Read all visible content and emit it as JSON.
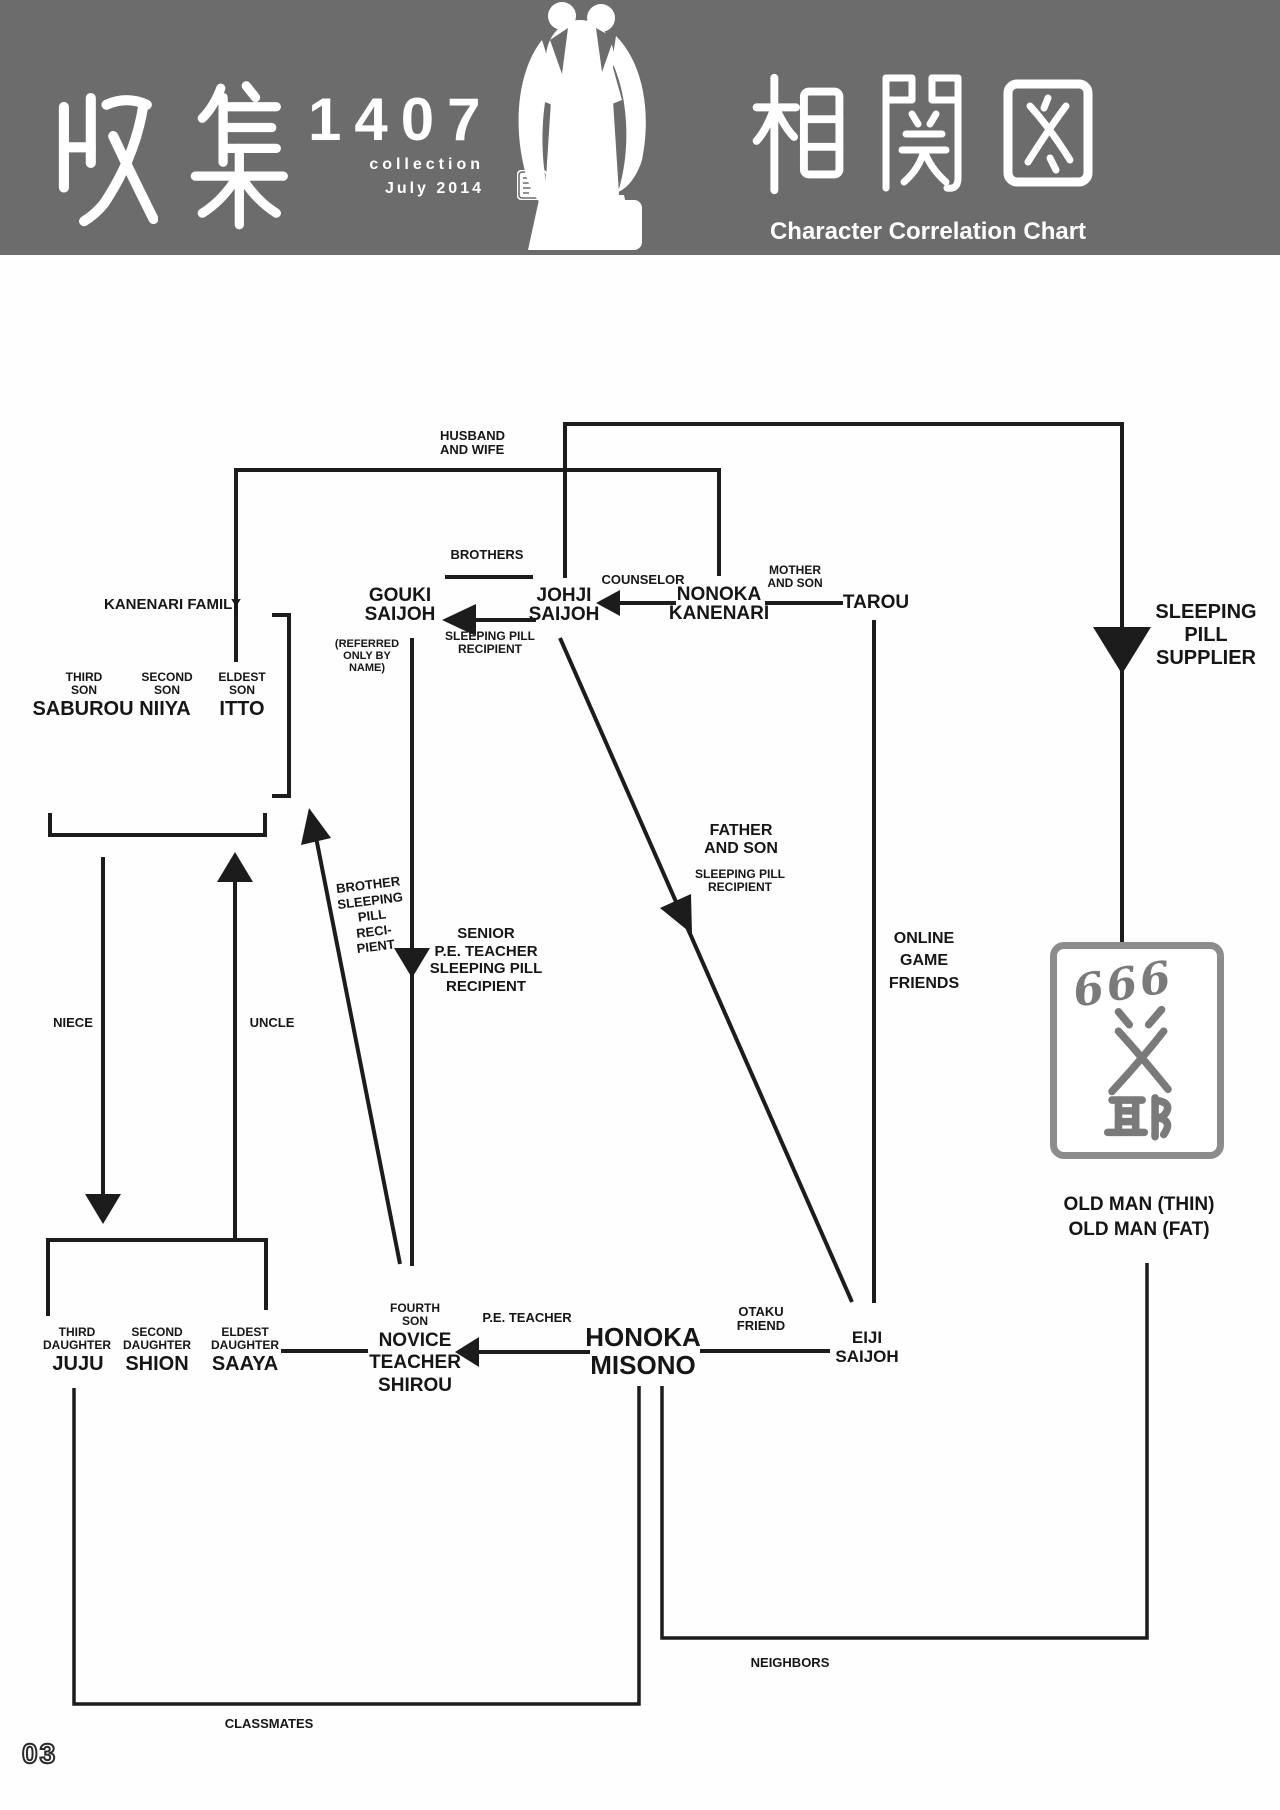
{
  "header": {
    "title_kanji_left": "収集",
    "title_number": "1407",
    "subtitle1": "collection",
    "subtitle2": "July 2014",
    "badge_d": "D",
    "title_kanji_right": "相関図",
    "subtitle_en": "Character Correlation Chart"
  },
  "colors": {
    "banner_gray": "#6c6c6c",
    "line_black": "#1c1c1c",
    "box_border_gray": "#8c8c8c",
    "calligraphy_gray": "#7a7a7a"
  },
  "groups": {
    "kanenari_family": "KANENARI FAMILY"
  },
  "nodes": {
    "saburou": {
      "role1": "THIRD",
      "role2": "SON",
      "name": "SABUROU"
    },
    "niiya": {
      "role1": "SECOND",
      "role2": "SON",
      "name": "NIIYA"
    },
    "itto": {
      "role1": "ELDEST",
      "role2": "SON",
      "name": "ITTO"
    },
    "gouki": {
      "name1": "GOUKI",
      "name2": "SAIJOH",
      "note1": "(REFERRED",
      "note2": "ONLY BY",
      "note3": "NAME)"
    },
    "johji": {
      "name1": "JOHJI",
      "name2": "SAIJOH"
    },
    "nonoka": {
      "name1": "NONOKA",
      "name2": "KANENARI"
    },
    "tarou": {
      "name": "TAROU"
    },
    "juju": {
      "role1": "THIRD",
      "role2": "DAUGHTER",
      "name": "JUJU"
    },
    "shion": {
      "role1": "SECOND",
      "role2": "DAUGHTER",
      "name": "SHION"
    },
    "saaya": {
      "role1": "ELDEST",
      "role2": "DAUGHTER",
      "name": "SAAYA"
    },
    "shirou": {
      "role1": "FOURTH",
      "role2": "SON",
      "name1": "NOVICE",
      "name2": "TEACHER",
      "name3": "SHIROU"
    },
    "honoka": {
      "name1": "HONOKA",
      "name2": "MISONO"
    },
    "eiji": {
      "name1": "EIJI",
      "name2": "SAIJOH"
    },
    "oldmen": {
      "box_number": "666",
      "box_kanji": "爺",
      "caption1": "OLD MAN (THIN)",
      "caption2": "OLD MAN (FAT)"
    }
  },
  "rel": {
    "husband_wife": [
      "HUSBAND",
      "AND WIFE"
    ],
    "brothers": "BROTHERS",
    "counselor": "COUNSELOR",
    "mother_son": [
      "MOTHER",
      "AND SON"
    ],
    "pill_recipient": [
      "SLEEPING PILL",
      "RECIPIENT"
    ],
    "supplier": [
      "SLEEPING",
      "PILL",
      "SUPPLIER"
    ],
    "senior": [
      "SENIOR",
      "P.E. TEACHER",
      "SLEEPING PILL",
      "RECIPIENT"
    ],
    "brother_pill": [
      "BROTHER",
      "SLEEPING",
      "PILL",
      "RECI-",
      "PIENT"
    ],
    "father_son": [
      "FATHER",
      "AND SON"
    ],
    "father_son_sub": [
      "SLEEPING PILL",
      "RECIPIENT"
    ],
    "online": [
      "ONLINE",
      "GAME",
      "FRIENDS"
    ],
    "niece": "NIECE",
    "uncle": "UNCLE",
    "pe_teacher": "P.E. TEACHER",
    "otaku": [
      "OTAKU",
      "FRIEND"
    ],
    "neighbors": "NEIGHBORS",
    "classmates": "CLASSMATES"
  },
  "page_number": "03"
}
